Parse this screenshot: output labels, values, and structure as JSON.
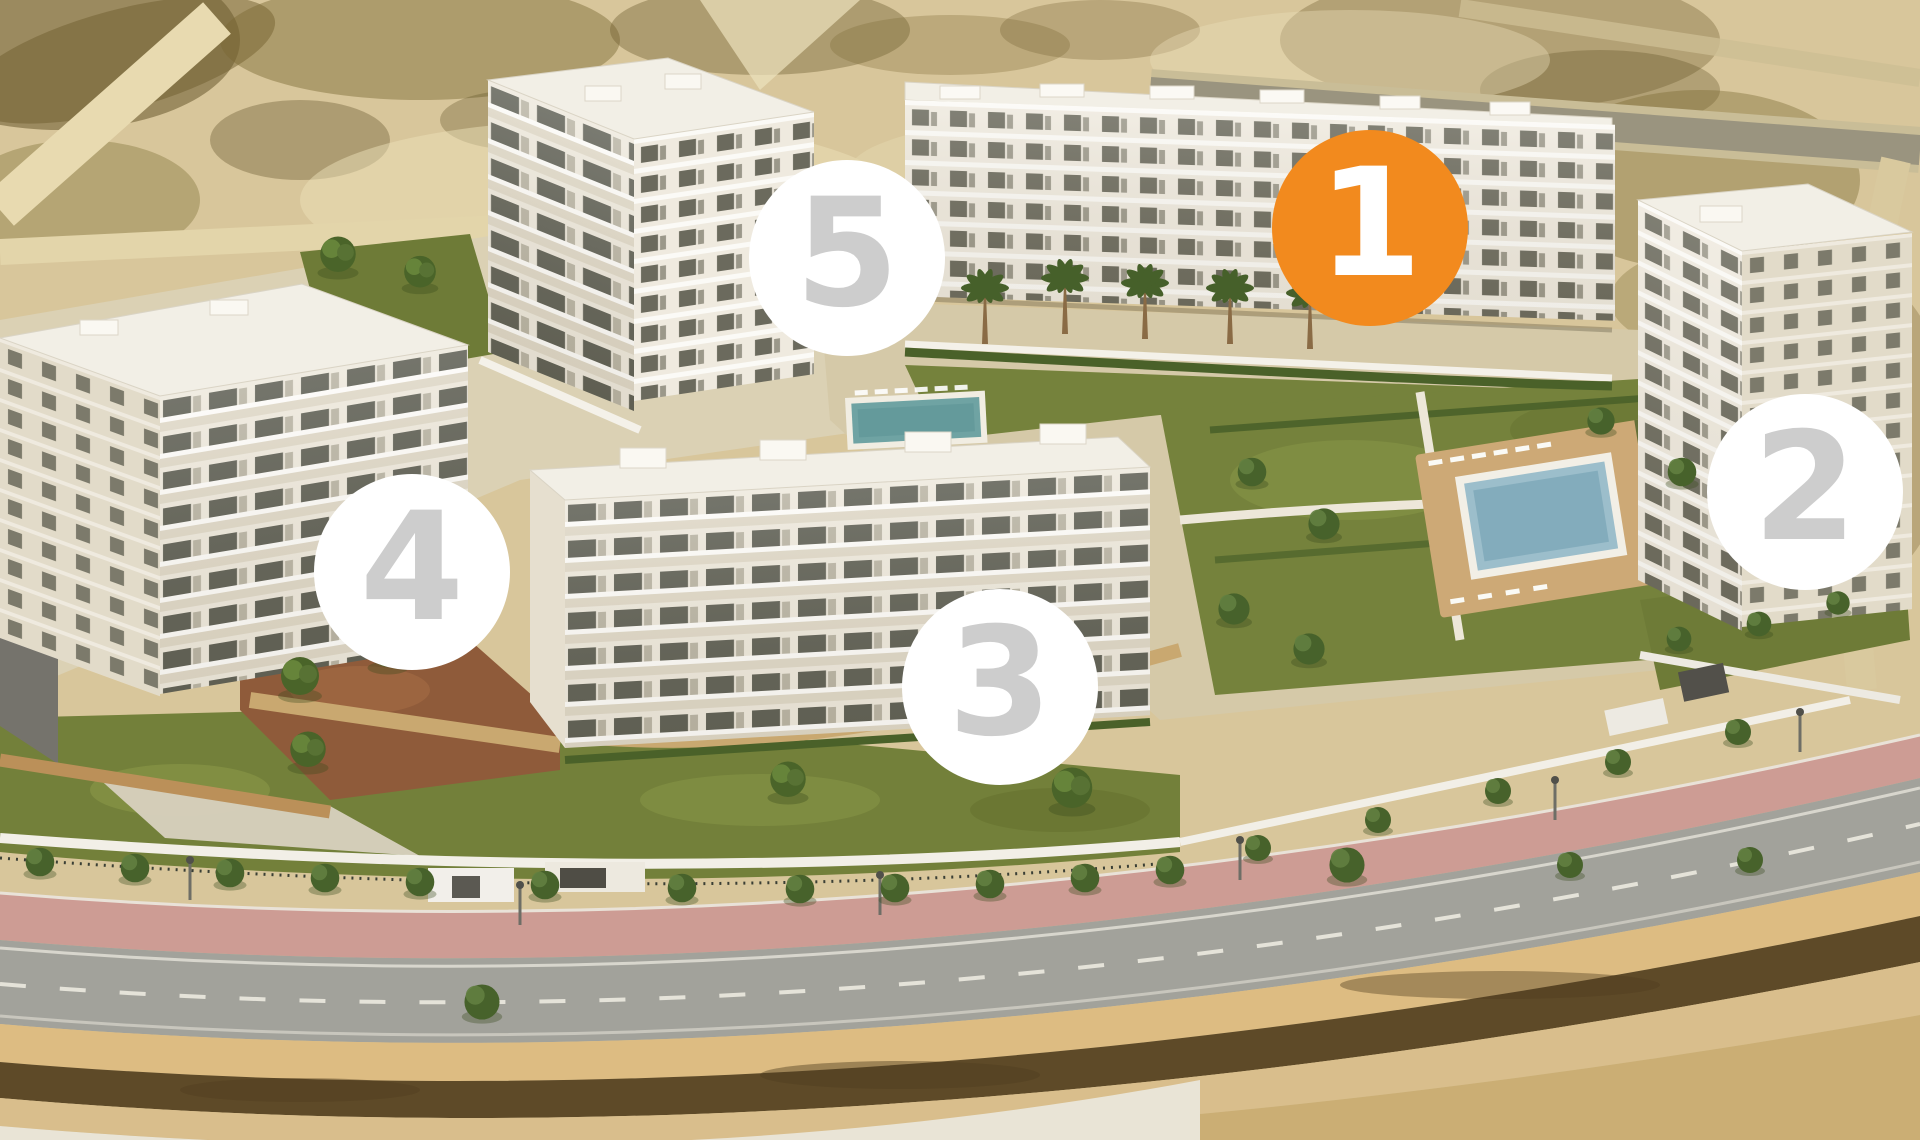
{
  "scene": {
    "palette": {
      "marker_highlight_bg": "#F28A1E",
      "marker_default_bg": "#FFFFFF",
      "marker_number_gray": "#CDCDCD",
      "marker_number_white": "#FFFFFF"
    }
  },
  "markers": [
    {
      "label": "1",
      "highlighted": true,
      "bg": "#F28A1E",
      "fg": "#FFFFFF"
    },
    {
      "label": "2",
      "highlighted": false,
      "bg": "#FFFFFF",
      "fg": "#CDCDCD"
    },
    {
      "label": "3",
      "highlighted": false,
      "bg": "#FFFFFF",
      "fg": "#CDCDCD"
    },
    {
      "label": "4",
      "highlighted": false,
      "bg": "#FFFFFF",
      "fg": "#CDCDCD"
    },
    {
      "label": "5",
      "highlighted": false,
      "bg": "#FFFFFF",
      "fg": "#CDCDCD"
    }
  ]
}
